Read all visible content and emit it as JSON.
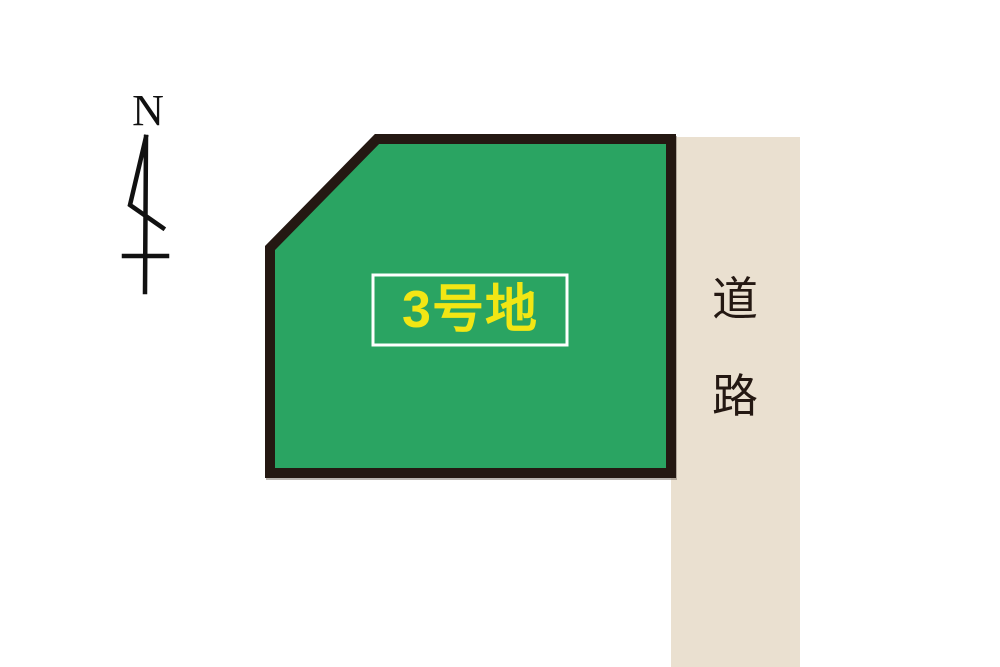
{
  "page": {
    "background": "#FFFFFF"
  },
  "compass": {
    "label": "N",
    "color": "#111111"
  },
  "lot": {
    "fill": "#2AA462",
    "outline": "#241812",
    "label": {
      "text": "3号地",
      "color": "#F2E614",
      "box_border": "#FFFFFF"
    }
  },
  "road": {
    "label": "道路",
    "chars": [
      "道",
      "路"
    ],
    "fill": "#EAE0D0",
    "text_color": "#241812"
  }
}
